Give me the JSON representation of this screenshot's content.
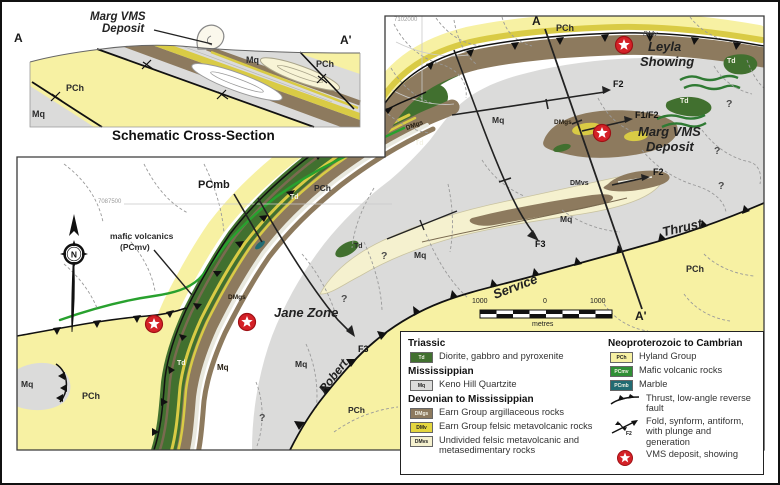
{
  "cross_section": {
    "deposit_label_line1": "Marg VMS",
    "deposit_label_line2": "Deposit",
    "marker_left": "A",
    "marker_right": "A'",
    "unit_pch_left": "PCh",
    "unit_mq_left": "Mq",
    "unit_mq_right": "Mq",
    "unit_pch_right": "PCh",
    "caption": "Schematic Cross-Section"
  },
  "map": {
    "grid_label_top": "7102000",
    "grid_label_left": "7087500",
    "section_marker_top": "A",
    "section_marker_bottom": "A'",
    "compass_n": "N",
    "labels": {
      "leyla_line1": "Leyla",
      "leyla_line2": "Showing",
      "marg_line1": "Marg VMS",
      "marg_line2": "Deposit",
      "jane": "Jane Zone",
      "pcmb": "PCmb",
      "mafic_line1": "mafic volcanics",
      "mafic_line2": "(PCmv)",
      "robert": "Robert",
      "service": "Service",
      "thrust": "Thrust",
      "f2": "F2",
      "f1f2": "F1/F2",
      "f3": "F3",
      "question": "?"
    },
    "units": {
      "pch": "PCh",
      "mq": "Mq",
      "td": "Td",
      "dmgs": "DMgs",
      "dmv": "DMv",
      "dmvs": "DMvs"
    },
    "scale": {
      "left": "1000",
      "zero": "0",
      "right": "1000",
      "unit": "metres"
    }
  },
  "legend": {
    "sections": [
      {
        "heading": "Triassic",
        "items": [
          {
            "code": "Td",
            "color": "#41702f",
            "text_color": "#f2f1e4",
            "label": "Diorite, gabbro and pyroxenite"
          }
        ]
      },
      {
        "heading": "Mississippian",
        "items": [
          {
            "code": "Mq",
            "color": "#dbdbda",
            "text_color": "#222222",
            "label": "Keno Hill Quartzite"
          }
        ]
      },
      {
        "heading": "Devonian to Mississippian",
        "items": [
          {
            "code": "DMgs",
            "color": "#8d7a5e",
            "text_color": "#f2f1e4",
            "label": "Earn Group argillaceous rocks"
          },
          {
            "code": "DMv",
            "color": "#e4d63e",
            "text_color": "#222222",
            "label": "Earn Group felsic metavolcanic rocks"
          },
          {
            "code": "DMvs",
            "color": "#f5f1cf",
            "text_color": "#222222",
            "label": "Undivided felsic metavolcanic and metasedimentary rocks"
          }
        ]
      },
      {
        "heading": "Neoproterozoic to Cambrian",
        "items": [
          {
            "code": "PCh",
            "color": "#f7f1a3",
            "text_color": "#222222",
            "label": "Hyland Group"
          },
          {
            "code": "PCmv",
            "color": "#2f8f35",
            "text_color": "#f2f1e4",
            "label": "Mafic volcanic rocks"
          },
          {
            "code": "PCmb",
            "color": "#226b72",
            "text_color": "#f2f1e4",
            "label": "Marble"
          }
        ]
      }
    ],
    "symbols": [
      {
        "label": "Thrust, low-angle reverse fault"
      },
      {
        "label": "Fold, synform, antiform, with plunge and generation",
        "tag": "F2"
      },
      {
        "label": "VMS deposit, showing"
      }
    ],
    "colors": {
      "vms_red": "#d42127",
      "thrust_black": "#111111"
    }
  }
}
